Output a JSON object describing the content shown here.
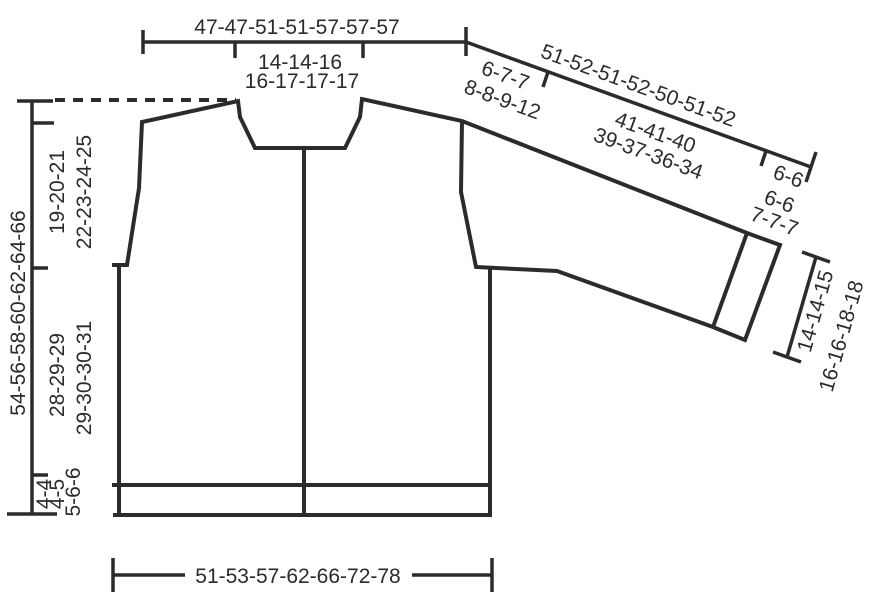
{
  "diagram": {
    "type": "garment-pattern-schematic",
    "garment": "cardigan front/back with drop sleeve",
    "colors": {
      "ink": "#2b2b2b",
      "background": "#ffffff"
    },
    "labels": {
      "top_shoulder_width": "47-47-51-51-57-57-57",
      "neck_width_line1": "14-14-16",
      "neck_width_line2": "16-17-17-17",
      "sleeve_edge_total": "51-52-51-52-50-51-52",
      "shoulder_segment_line1": "6-7-7",
      "shoulder_segment_line2": "8-8-9-12",
      "sleeve_length_line1": "41-41-40",
      "sleeve_length_line2": "39-37-36-34",
      "cuff_segment_line1": "6-6",
      "cuff_segment_line2": "6-6",
      "cuff_segment_line3": "7-7-7",
      "cuff_width_line1": "14-14-15",
      "cuff_width_line2": "16-16-18-18",
      "total_length": "54-56-58-60-62-64-66",
      "armhole_depth_line1": "19-20-21",
      "armhole_depth_line2": "22-23-24-25",
      "body_length_line1": "28-29-29",
      "body_length_line2": "29-30-30-31",
      "hem_band_line1": "4-4",
      "hem_band_line2": "4-5",
      "hem_band_line3": "5-6-6",
      "bottom_width": "51-53-57-62-66-72-78"
    }
  }
}
